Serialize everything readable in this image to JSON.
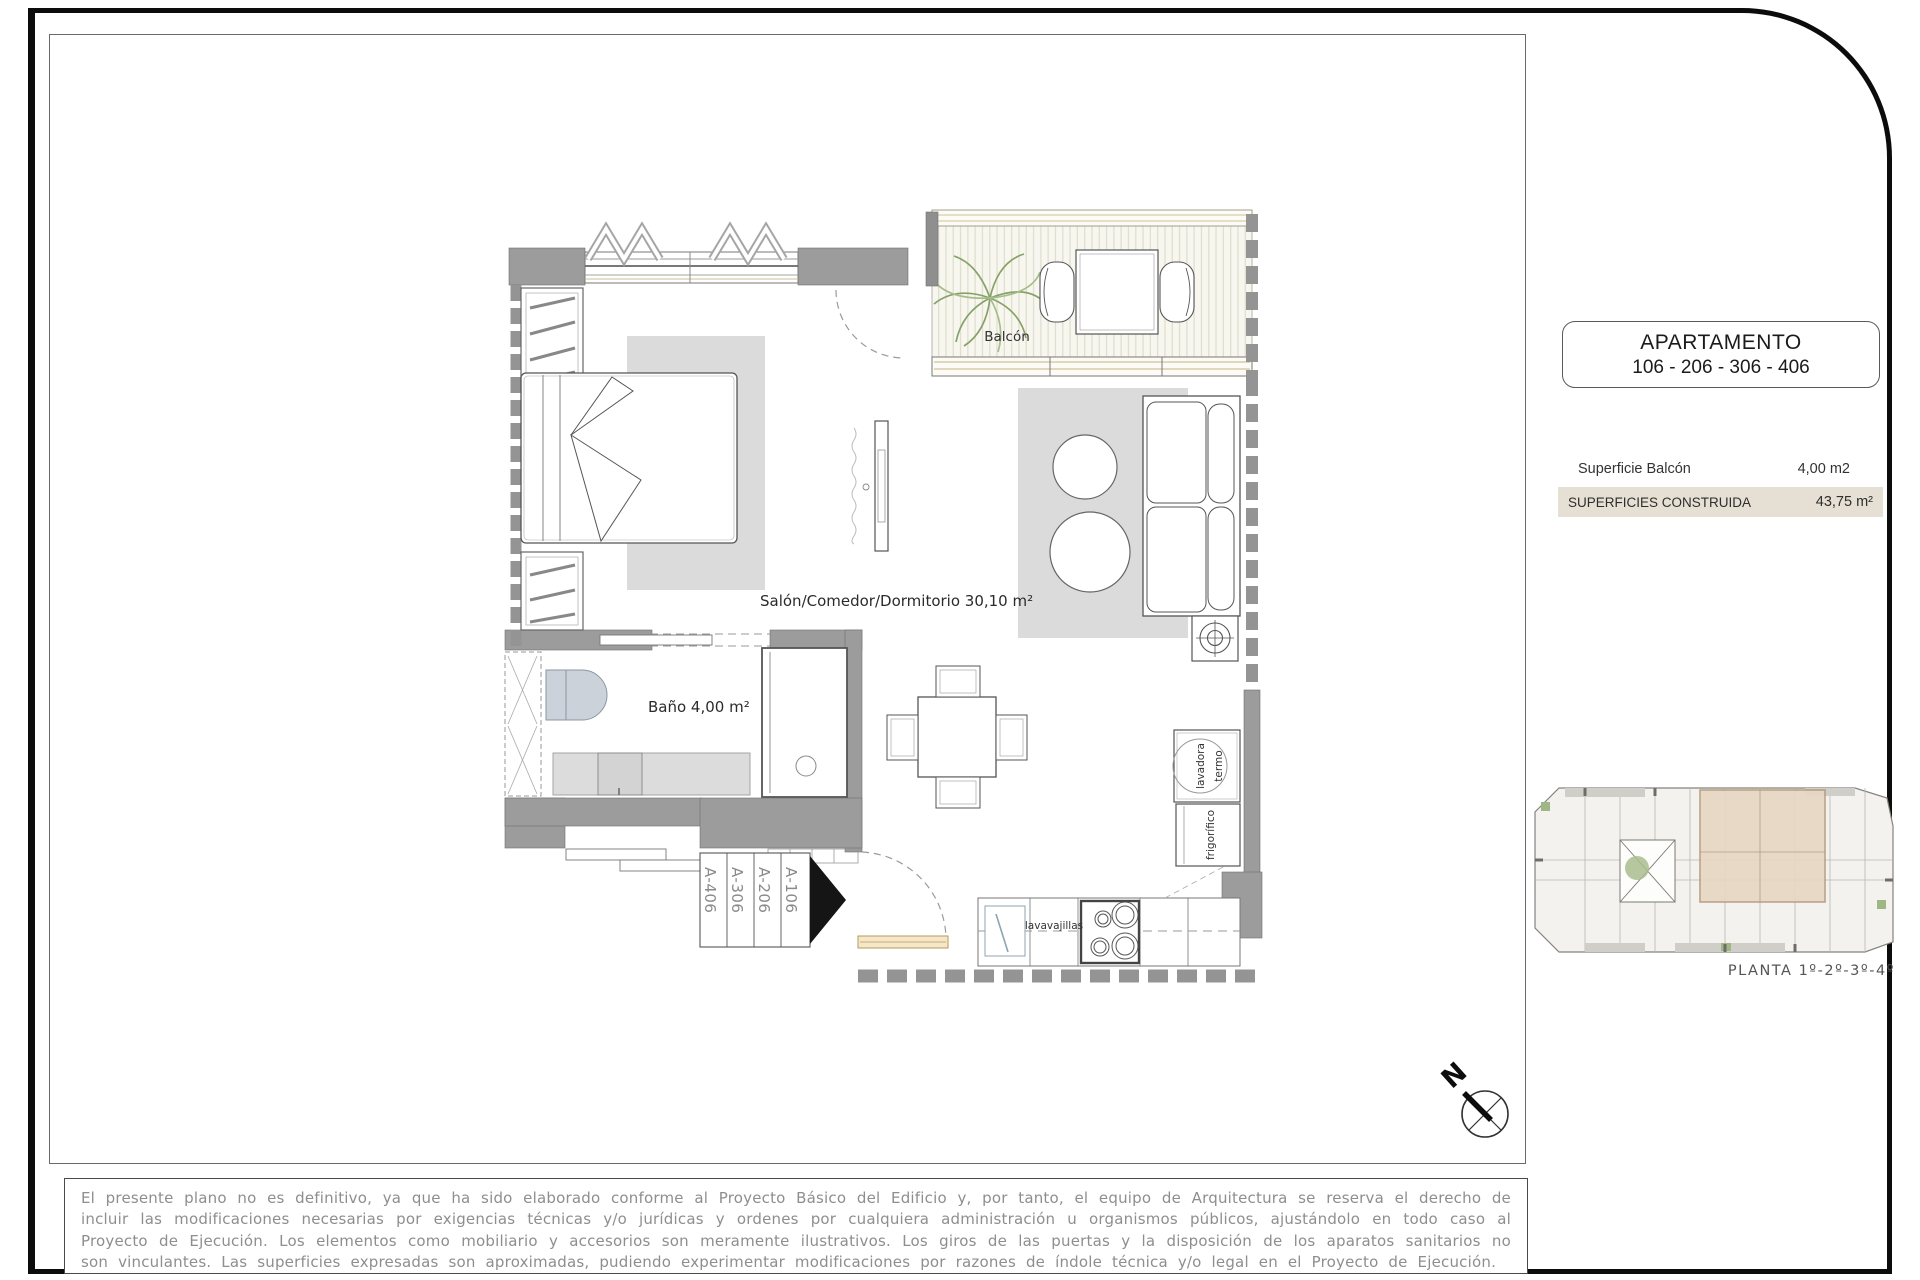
{
  "title_box": {
    "line1": "APARTAMENTO",
    "line2": "106 - 206 - 306 - 406"
  },
  "surface_table": {
    "rows": [
      {
        "label": "Superficie Balcón",
        "value": "4,00 m2"
      },
      {
        "label": "SUPERFICIES CONSTRUIDA",
        "value": "43,75 m²"
      }
    ]
  },
  "floor_plan": {
    "rooms": {
      "living": "Salón/Comedor/Dormitorio  30,10 m²",
      "bath": "Baño  4,00 m²",
      "balcony": "Balcón"
    },
    "appliances": {
      "dishwasher": "lavavajillas",
      "water_heater": "termo",
      "washer": "lavadora",
      "fridge": "frigorífico"
    },
    "unit_labels": [
      "A-406",
      "A-306",
      "A-206",
      "A-106"
    ]
  },
  "key_plan": {
    "caption": "PLANTA 1º-2º-3º-4º"
  },
  "compass": {
    "north": "N"
  },
  "disclaimer": "El presente plano no es definitivo, ya que ha sido elaborado conforme al Proyecto Básico del Edificio y, por tanto, el equipo de Arquitectura se reserva el derecho de incluir las modificaciones necesarias por exigencias técnicas y/o jurídicas y ordenes por cualquiera administración u organismos públicos, ajustándolo en todo caso al Proyecto de Ejecución. Los elementos como mobiliario y accesorios son meramente ilustrativos. Los giros de las puertas y la disposición de los aparatos sanitarios no son vinculantes. Las superficies expresadas son aproximadas, pudiendo experimentar modificaciones por razones de índole técnica y/o legal en el Proyecto de Ejecución.",
  "colors": {
    "wall_gray": "#9c9c9c",
    "highlight_row_beige": "#e6dfd3",
    "rug_gray": "#dbdbdb",
    "balcony_deck": "#f7f6ef",
    "plant_green": "#86a268",
    "door_beige": "#f6e7c6",
    "keyplan_unit_highlight": "#e7d7c3"
  }
}
